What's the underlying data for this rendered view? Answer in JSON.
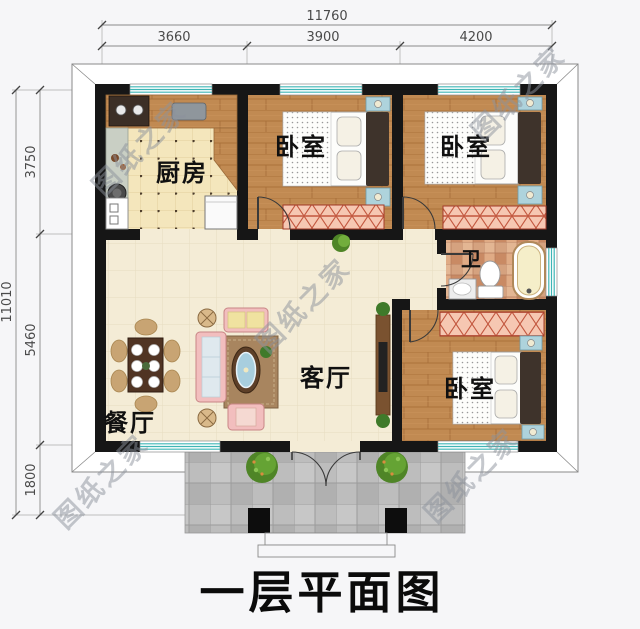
{
  "title": "一层平面图",
  "watermark_text": "图纸之家",
  "dims": {
    "top_total": "11760",
    "top_segments": [
      "3660",
      "3900",
      "4200"
    ],
    "left_total": "11010",
    "left_segments": [
      "3750",
      "5460",
      "1800"
    ]
  },
  "rooms": {
    "kitchen": "厨房",
    "bedroom_top_middle": "卧室",
    "bedroom_top_right": "卧室",
    "bedroom_bottom_right": "卧室",
    "bathroom": "卫",
    "living_room": "客厅",
    "dining_room": "餐厅"
  },
  "colors": {
    "wall": "#161616",
    "window_teal": "#3fb5b5",
    "wood_floor": "#c18a52",
    "kitchen_tile": "#f4e6bc",
    "living_tile": "#f4ecd6",
    "wardrobe_pink": "#f6c7b2",
    "porch_gray": "#bdbdbd",
    "background": "#f6f6f8"
  }
}
